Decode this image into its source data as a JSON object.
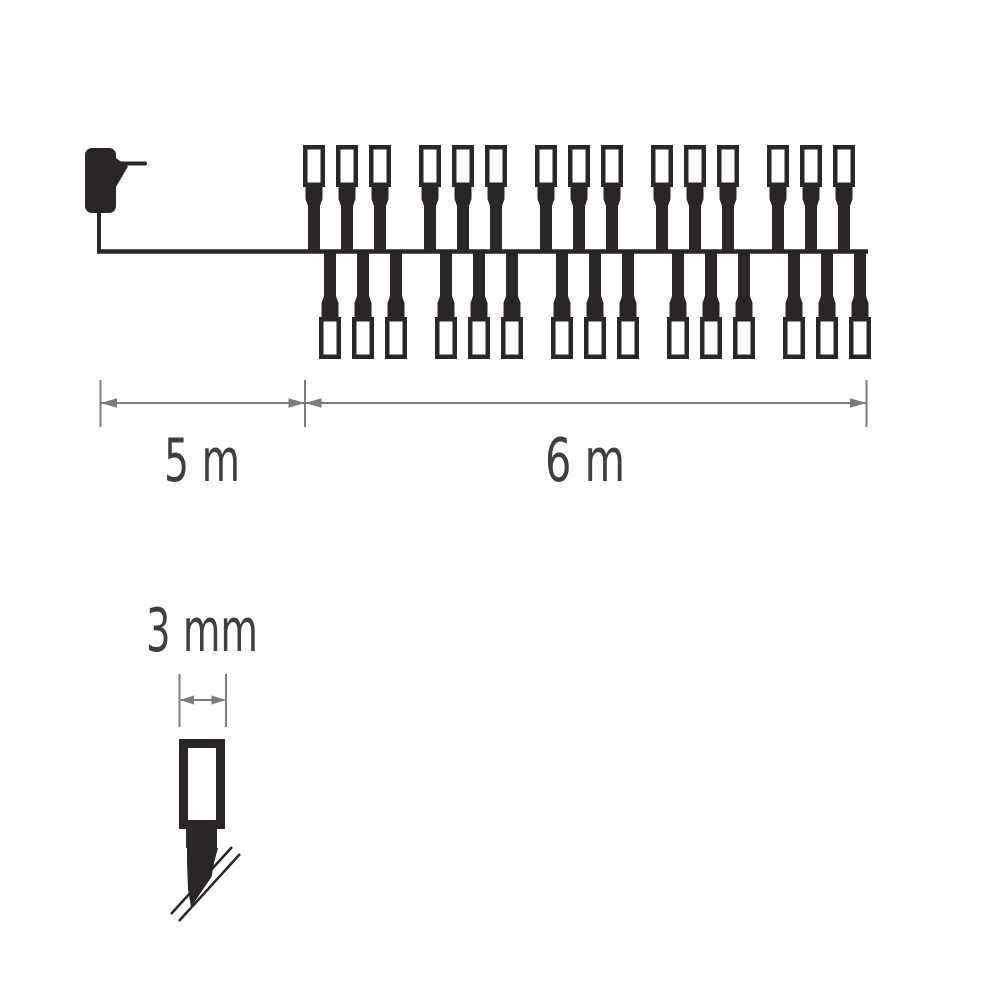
{
  "page": {
    "background": "#ffffff",
    "description": "Dimension diagram of an LED light chain with power adapter"
  },
  "diagram": {
    "type": "product-dimension-diagram",
    "subject": "LED christmas light chain",
    "labels": {
      "lead_length": "5 m",
      "lit_length": "6 m",
      "bulb_diameter": "3 mm"
    },
    "structure": {
      "clusters": 5,
      "bulbs_per_cluster_top": 3,
      "bulbs_per_cluster_bottom": 3,
      "total_bulbs": 30
    },
    "colors": {
      "ink": "#2a2627",
      "dimension": "#7c7c7c",
      "text": "#3f3f3f",
      "bulb_fill": "#ffffff",
      "background": "#ffffff"
    }
  }
}
